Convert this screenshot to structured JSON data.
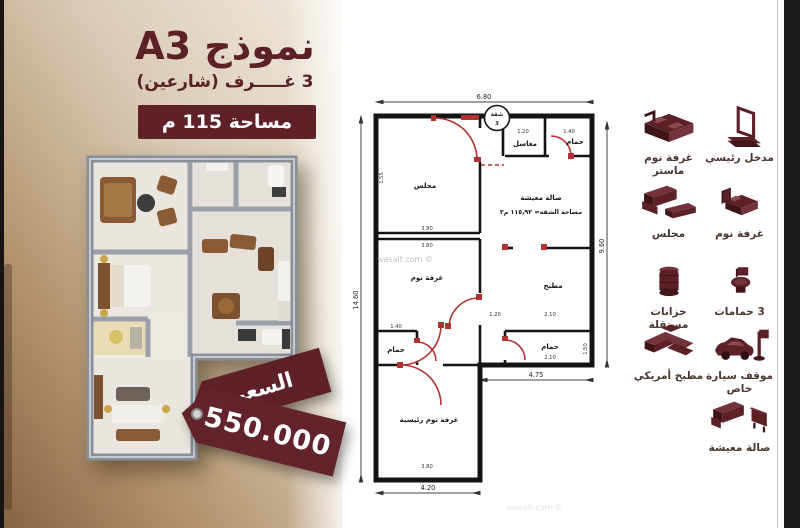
{
  "colors": {
    "maroon": "#5c2127",
    "badge_bg": "#5e2127",
    "panel_gradient_light": "#f1ebe1",
    "panel_gradient_dark": "#876345",
    "plan_red": "#b23232",
    "wall_black": "#141414",
    "render_wall_grey": "#8d939d"
  },
  "panel": {
    "model_title": "نموذج A3",
    "subtitle": "3 غـــــرف (شارعين)",
    "area_badge": "مساحة 115 م",
    "price_label": "السعر",
    "price_value": "550.000"
  },
  "watermark": "wasalt.com ©",
  "plan": {
    "stamp_line1": "شقة",
    "stamp_line2": "3",
    "rooms": {
      "majlis": "مجلس",
      "living": "صالة معيشة",
      "area_line": "مساحة الشقة= ١١٥٫٩٢ م٢",
      "sinks": "مغاسل",
      "bath": "حمام",
      "kitchen": "مطبخ",
      "bedroom": "غرفة نوم",
      "master_bedroom": "غرفة نوم رئيسية"
    },
    "dims": {
      "top": "6.80",
      "left": "14.60",
      "right": "9.60",
      "bottom": "4.20",
      "wing_bottom": "4.75",
      "d380": "3.80",
      "d140": "1.40",
      "d120": "1.20",
      "d210": "2.10",
      "d155": "1.55",
      "d150": "1.50"
    }
  },
  "legend": {
    "items": [
      {
        "icon": "main-entrance-icon",
        "label": "مدخل رئيسي"
      },
      {
        "icon": "master-bedroom-icon",
        "label": "غرفة نوم ماستر"
      },
      {
        "icon": "bedroom-icon",
        "label": "غرفة نوم"
      },
      {
        "icon": "majlis-icon",
        "label": "مجلس"
      },
      {
        "icon": "bathrooms-icon",
        "label": "3 حمامات"
      },
      {
        "icon": "water-tanks-icon",
        "label": "خزانات مستقلة"
      },
      {
        "icon": "parking-icon",
        "label": "موقف سيارة خاص"
      },
      {
        "icon": "american-kitchen-icon",
        "label": "مطبخ أمريكي"
      },
      {
        "icon": "living-room-icon",
        "label": "صالة معيشة"
      }
    ]
  }
}
